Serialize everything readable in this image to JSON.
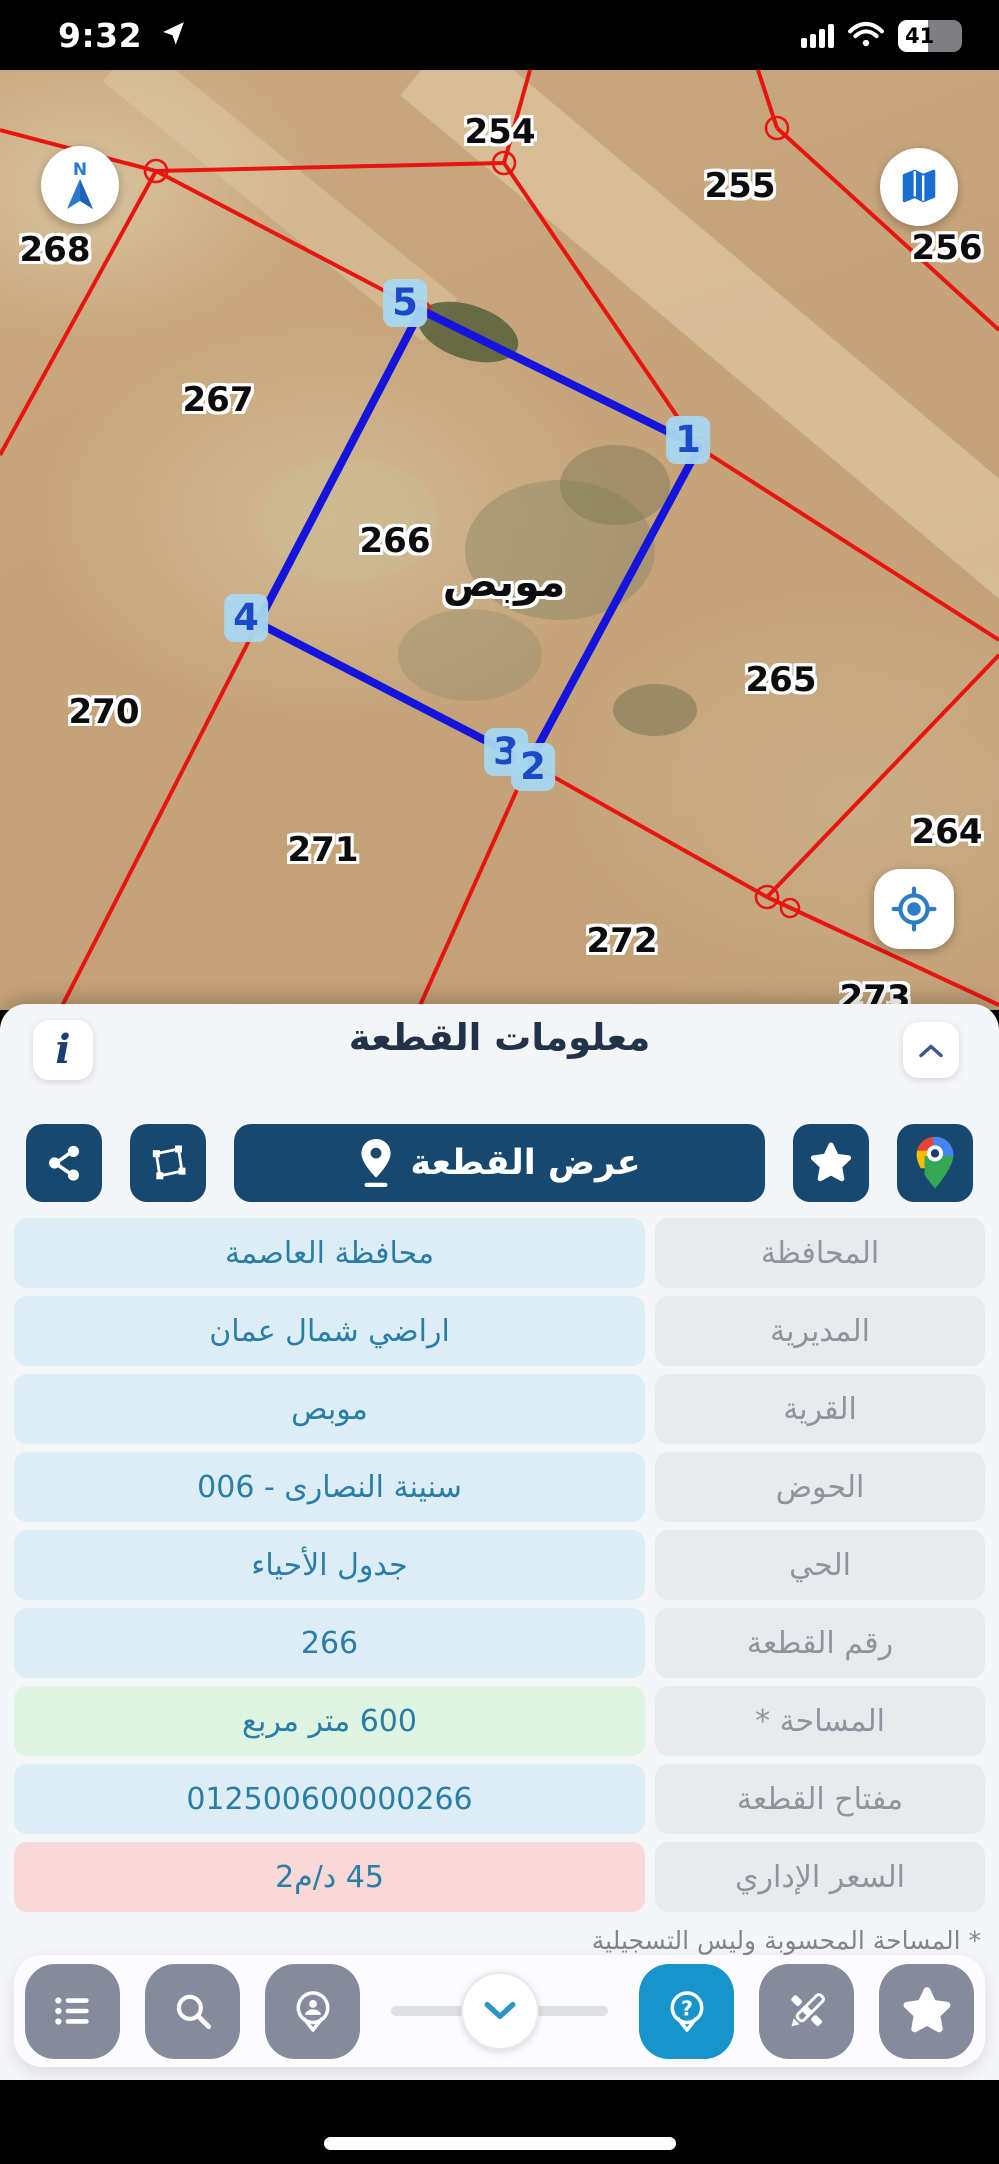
{
  "status_bar": {
    "time": "9:32",
    "battery_percent": "41"
  },
  "map": {
    "compass_letter": "N",
    "parcel_labels": [
      {
        "text": "254",
        "x": 500,
        "y": 62
      },
      {
        "text": "255",
        "x": 740,
        "y": 116
      },
      {
        "text": "256",
        "x": 947,
        "y": 178
      },
      {
        "text": "268",
        "x": 55,
        "y": 180
      },
      {
        "text": "267",
        "x": 218,
        "y": 330
      },
      {
        "text": "266",
        "x": 395,
        "y": 471
      },
      {
        "text": "265",
        "x": 781,
        "y": 610
      },
      {
        "text": "270",
        "x": 104,
        "y": 642
      },
      {
        "text": "264",
        "x": 947,
        "y": 762
      },
      {
        "text": "271",
        "x": 323,
        "y": 780
      },
      {
        "text": "272",
        "x": 622,
        "y": 871
      },
      {
        "text": "273",
        "x": 875,
        "y": 928
      },
      {
        "text": "موبص",
        "x": 504,
        "y": 512,
        "place": true
      }
    ],
    "vertex_markers": [
      {
        "text": "5",
        "x": 405,
        "y": 233
      },
      {
        "text": "1",
        "x": 688,
        "y": 370
      },
      {
        "text": "4",
        "x": 246,
        "y": 548
      },
      {
        "text": "3",
        "x": 506,
        "y": 682
      },
      {
        "text": "2",
        "x": 533,
        "y": 697
      }
    ]
  },
  "sheet": {
    "title": "معلومات القطعة",
    "info_button": "i",
    "view_parcel_button": "عرض القطعة",
    "table": {
      "rows": [
        {
          "label": "المحافظة",
          "value": "محافظة العاصمة"
        },
        {
          "label": "المديرية",
          "value": "اراضي شمال عمان"
        },
        {
          "label": "القرية",
          "value": "موبص"
        },
        {
          "label": "الحوض",
          "value": "سنينة النصارى - 006"
        },
        {
          "label": "الحي",
          "value": "جدول الأحياء"
        },
        {
          "label": "رقم القطعة",
          "value": "266"
        },
        {
          "label": "المساحة *",
          "value": "600  متر مربع"
        },
        {
          "label": "مفتاح القطعة",
          "value": "012500600000266"
        },
        {
          "label": "السعر الإداري",
          "value": "45 د/م2"
        }
      ]
    },
    "footnote": "* المساحة المحسوبة وليس التسجيلية"
  },
  "colors": {
    "accent_navy": "#17486f",
    "active_blue": "#1794ca",
    "value_text": "#2a7ea6",
    "map_line_red": "#e81410",
    "parcel_highlight_blue": "#1414dd",
    "vertex_bubble": "#a8d8f0"
  }
}
